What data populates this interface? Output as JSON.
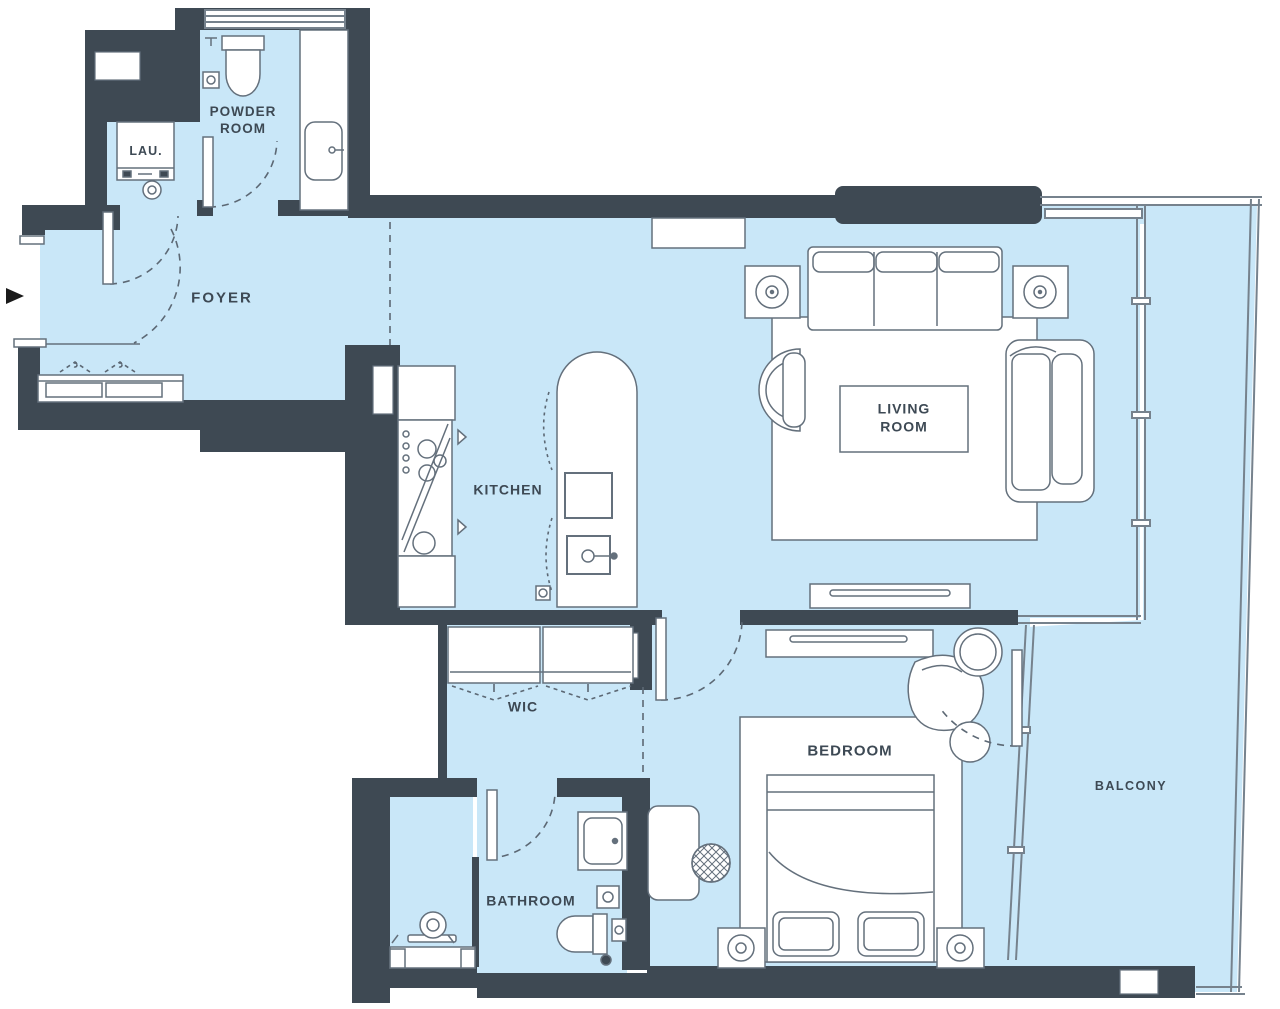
{
  "title": "Apartment floor plan",
  "rooms": {
    "powder_room": {
      "label": "POWDER ROOM"
    },
    "laundry": {
      "label": "LAU."
    },
    "foyer": {
      "label": "FOYER"
    },
    "kitchen": {
      "label": "KITCHEN"
    },
    "living_room": {
      "label": "LIVING ROOM"
    },
    "wic": {
      "label": "WIC"
    },
    "bedroom": {
      "label": "BEDROOM"
    },
    "bathroom": {
      "label": "BATHROOM"
    },
    "balcony": {
      "label": "BALCONY"
    }
  },
  "colors": {
    "wall": "#3e4953",
    "floor": "#c9e7f8",
    "fixture_outline": "#64707c",
    "dash": "#5c6874",
    "label_text": "#3d4954",
    "background": "#ffffff"
  }
}
